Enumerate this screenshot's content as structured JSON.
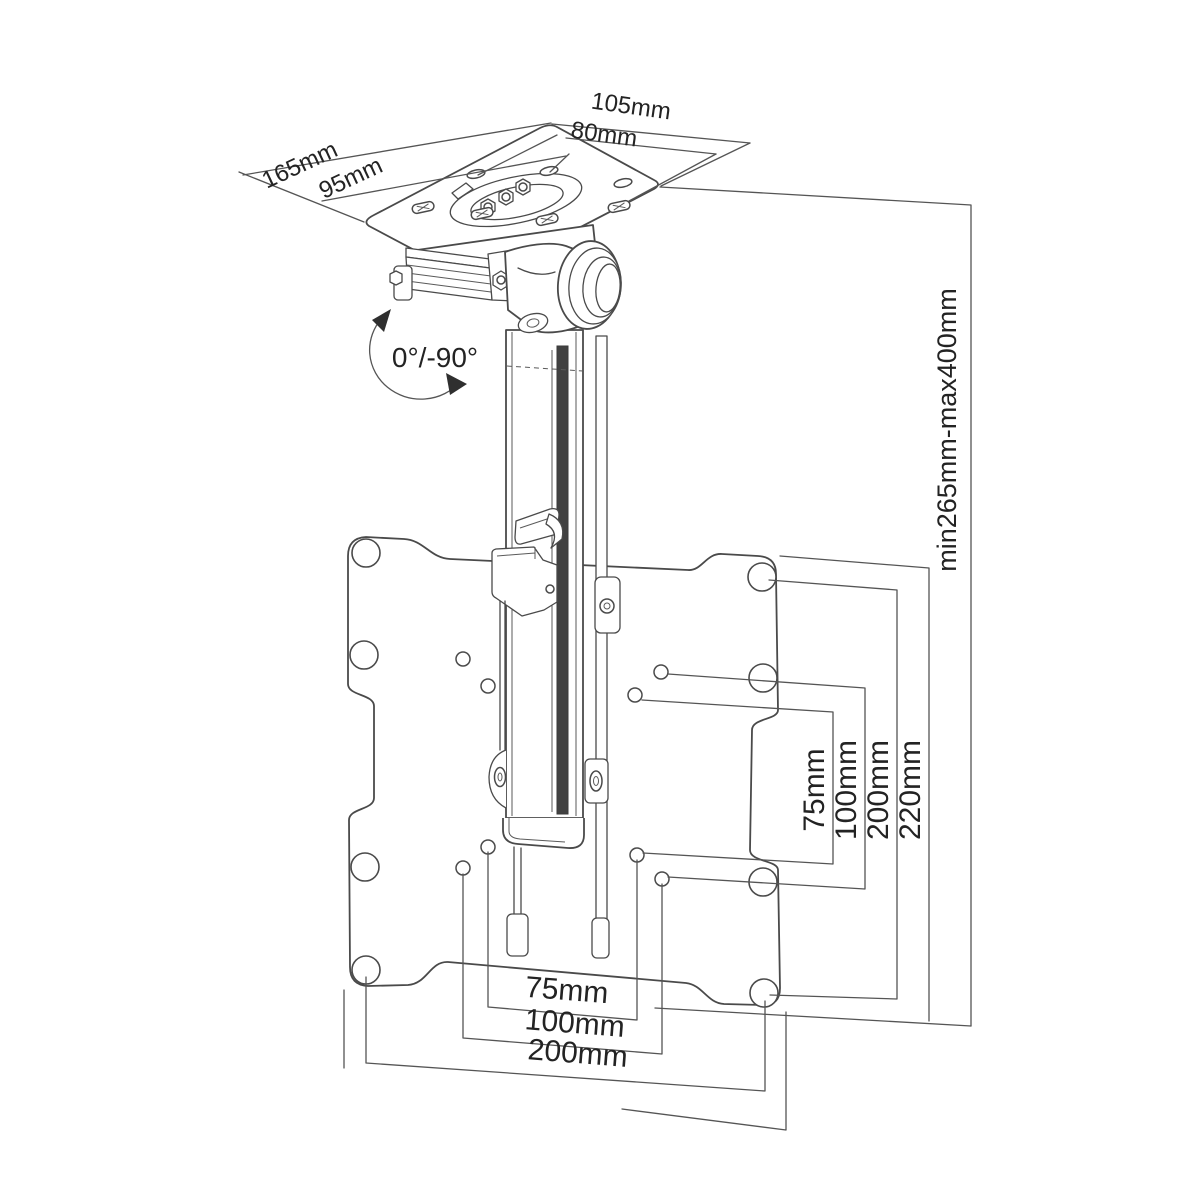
{
  "figure": {
    "description": "technical dimension drawing of fold-down ceiling TV mount",
    "colors": {
      "background": "#ffffff",
      "line": "#4a4a4a",
      "text": "#232323",
      "slot_shading": "#414141"
    },
    "labels": {
      "ceiling_plate": {
        "outer_width": "105mm",
        "inner_width": "80mm",
        "outer_depth": "165mm",
        "inner_depth": "95mm"
      },
      "fold_angle": "0°/-90°",
      "height_range": "min265mm-max400mm",
      "vesa_vertical": [
        "75mm",
        "100mm",
        "200mm",
        "220mm"
      ],
      "vesa_horizontal": [
        "75mm",
        "100mm",
        "200mm"
      ]
    }
  }
}
